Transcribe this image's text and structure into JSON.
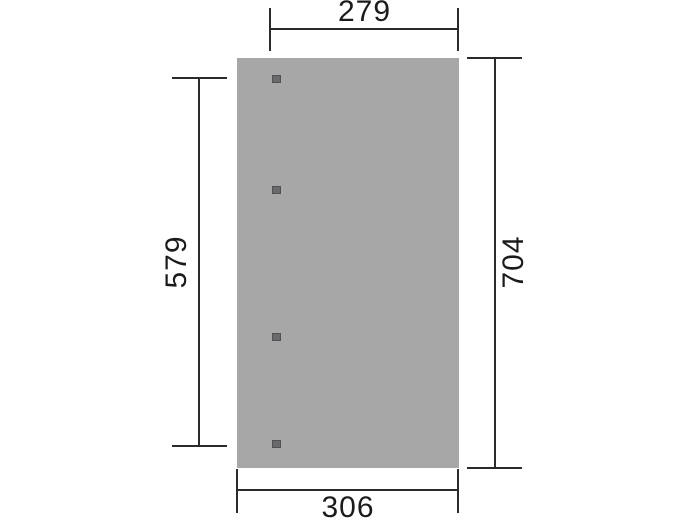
{
  "drawing": {
    "kind": "floor-plan-dimension-diagram",
    "dimensions": {
      "top": "279",
      "bottom": "306",
      "left": "579",
      "right": "704"
    },
    "colors": {
      "page_bg": "#ffffff",
      "surface": "#a7a7a7",
      "post_fill": "#69696b",
      "post_border": "#515153",
      "line": "#2b2b2b",
      "ink": "#1b1b1b"
    }
  }
}
